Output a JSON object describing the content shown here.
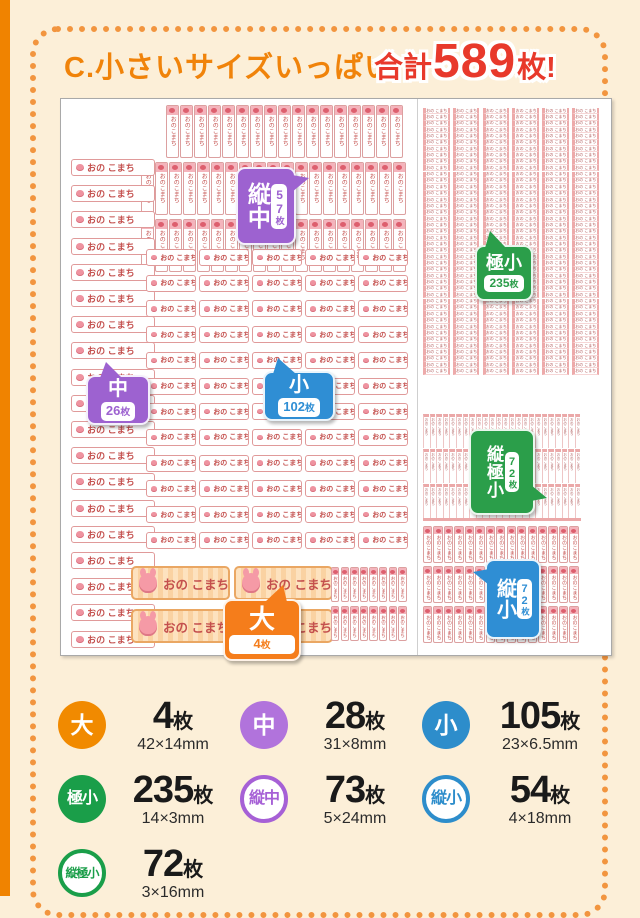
{
  "page": {
    "title": "C.小さいサイズいっぱい",
    "total_prefix": "合計",
    "total_number": "589",
    "total_suffix": "枚!"
  },
  "sticker": {
    "name": "おの こまち",
    "name_vertical": "おのこまち"
  },
  "badges": [
    {
      "id": "tate-chu",
      "label": "縦中",
      "count": "57",
      "unit": "枚",
      "color": "#9d62d0",
      "orientation": "vertical"
    },
    {
      "id": "goku-sho",
      "label": "極小",
      "count": "235",
      "unit": "枚",
      "color": "#2b9e4a",
      "orientation": "horizontal"
    },
    {
      "id": "chu",
      "label": "中",
      "count": "26",
      "unit": "枚",
      "color": "#9d62d0",
      "orientation": "horizontal"
    },
    {
      "id": "sho",
      "label": "小",
      "count": "102",
      "unit": "枚",
      "color": "#2f8ed4",
      "orientation": "horizontal"
    },
    {
      "id": "tate-goku-sho",
      "label": "縦極小",
      "count": "72",
      "unit": "枚",
      "color": "#2b9e4a",
      "orientation": "vertical"
    },
    {
      "id": "tate-sho",
      "label": "縦小",
      "count": "72",
      "unit": "枚",
      "color": "#2f8ed4",
      "orientation": "vertical"
    },
    {
      "id": "dai",
      "label": "大",
      "count": "4",
      "unit": "枚",
      "color": "#f57d1b",
      "orientation": "horizontal"
    }
  ],
  "legend": {
    "items": [
      {
        "label": "大",
        "count": "4",
        "unit": "枚",
        "size": "42×14mm",
        "color": "#f18a00",
        "style": "filled"
      },
      {
        "label": "中",
        "count": "28",
        "unit": "枚",
        "size": "31×8mm",
        "color": "#b173dc",
        "style": "filled"
      },
      {
        "label": "小",
        "count": "105",
        "unit": "枚",
        "size": "23×6.5mm",
        "color": "#2d8dcb",
        "style": "filled"
      },
      {
        "label": "極小",
        "count": "235",
        "unit": "枚",
        "size": "14×3mm",
        "color": "#1a9e49",
        "style": "filled"
      },
      {
        "label": "縦中",
        "count": "73",
        "unit": "枚",
        "size": "5×24mm",
        "color": "#a660d6",
        "style": "outline"
      },
      {
        "label": "縦小",
        "count": "54",
        "unit": "枚",
        "size": "4×18mm",
        "color": "#2d8dcb",
        "style": "outline"
      },
      {
        "label": "縦極小",
        "count": "72",
        "unit": "枚",
        "size": "3×16mm",
        "color": "#1a9e49",
        "style": "outline"
      }
    ]
  },
  "sheet": {
    "groups": [
      {
        "id": "tate-chu-row1",
        "type": "v",
        "left": 105,
        "top": 6,
        "rows": 1,
        "cols": 17,
        "px": 14,
        "py": 55,
        "w": 12.5,
        "h": 53,
        "fs": 6
      },
      {
        "id": "tate-chu-row2",
        "type": "v",
        "left": 80,
        "top": 63,
        "rows": 1,
        "cols": 19,
        "px": 14,
        "py": 55,
        "w": 12.5,
        "h": 53,
        "fs": 6
      },
      {
        "id": "tate-chu-row3",
        "type": "v",
        "left": 80,
        "top": 120,
        "rows": 1,
        "cols": 19,
        "px": 14,
        "py": 55,
        "w": 12.5,
        "h": 53,
        "fs": 6
      },
      {
        "id": "chu",
        "type": "h",
        "left": 10,
        "top": 60,
        "rows": 19,
        "cols": 1,
        "px": 86,
        "py": 26.2,
        "w": 84,
        "h": 17,
        "fs": 9
      },
      {
        "id": "sho",
        "type": "h",
        "left": 85,
        "top": 150,
        "rows": 12,
        "cols": 5,
        "px": 53,
        "py": 25.7,
        "w": 50,
        "h": 17,
        "fs": 7
      },
      {
        "id": "dai",
        "type": "dai",
        "left": 70,
        "top": 467,
        "rows": 2,
        "cols": 2,
        "px": 103,
        "py": 43,
        "w": 99,
        "h": 34,
        "fs": 12.5
      },
      {
        "id": "tate-sho-mini",
        "type": "v",
        "left": 270,
        "top": 468,
        "rows": 2,
        "cols": 8,
        "px": 9.6,
        "py": 39,
        "w": 8.4,
        "h": 35,
        "fs": 4.5
      },
      {
        "id": "goku-sho",
        "type": "tny",
        "left": 362,
        "top": 9,
        "rows": 42,
        "cols": 6,
        "px": 29.8,
        "py": 6.35,
        "w": 26.5,
        "h": 6.35
      },
      {
        "id": "tate-goku-sho",
        "type": "vtn",
        "left": 362,
        "top": 315,
        "rows": 3,
        "cols": 24,
        "px": 6.6,
        "py": 34.8,
        "w": 5.6,
        "h": 34
      },
      {
        "id": "tate-sho",
        "type": "v",
        "left": 362,
        "top": 427,
        "rows": 3,
        "cols": 15,
        "px": 10.45,
        "py": 40,
        "w": 9.3,
        "h": 37,
        "fs": 5
      }
    ]
  }
}
